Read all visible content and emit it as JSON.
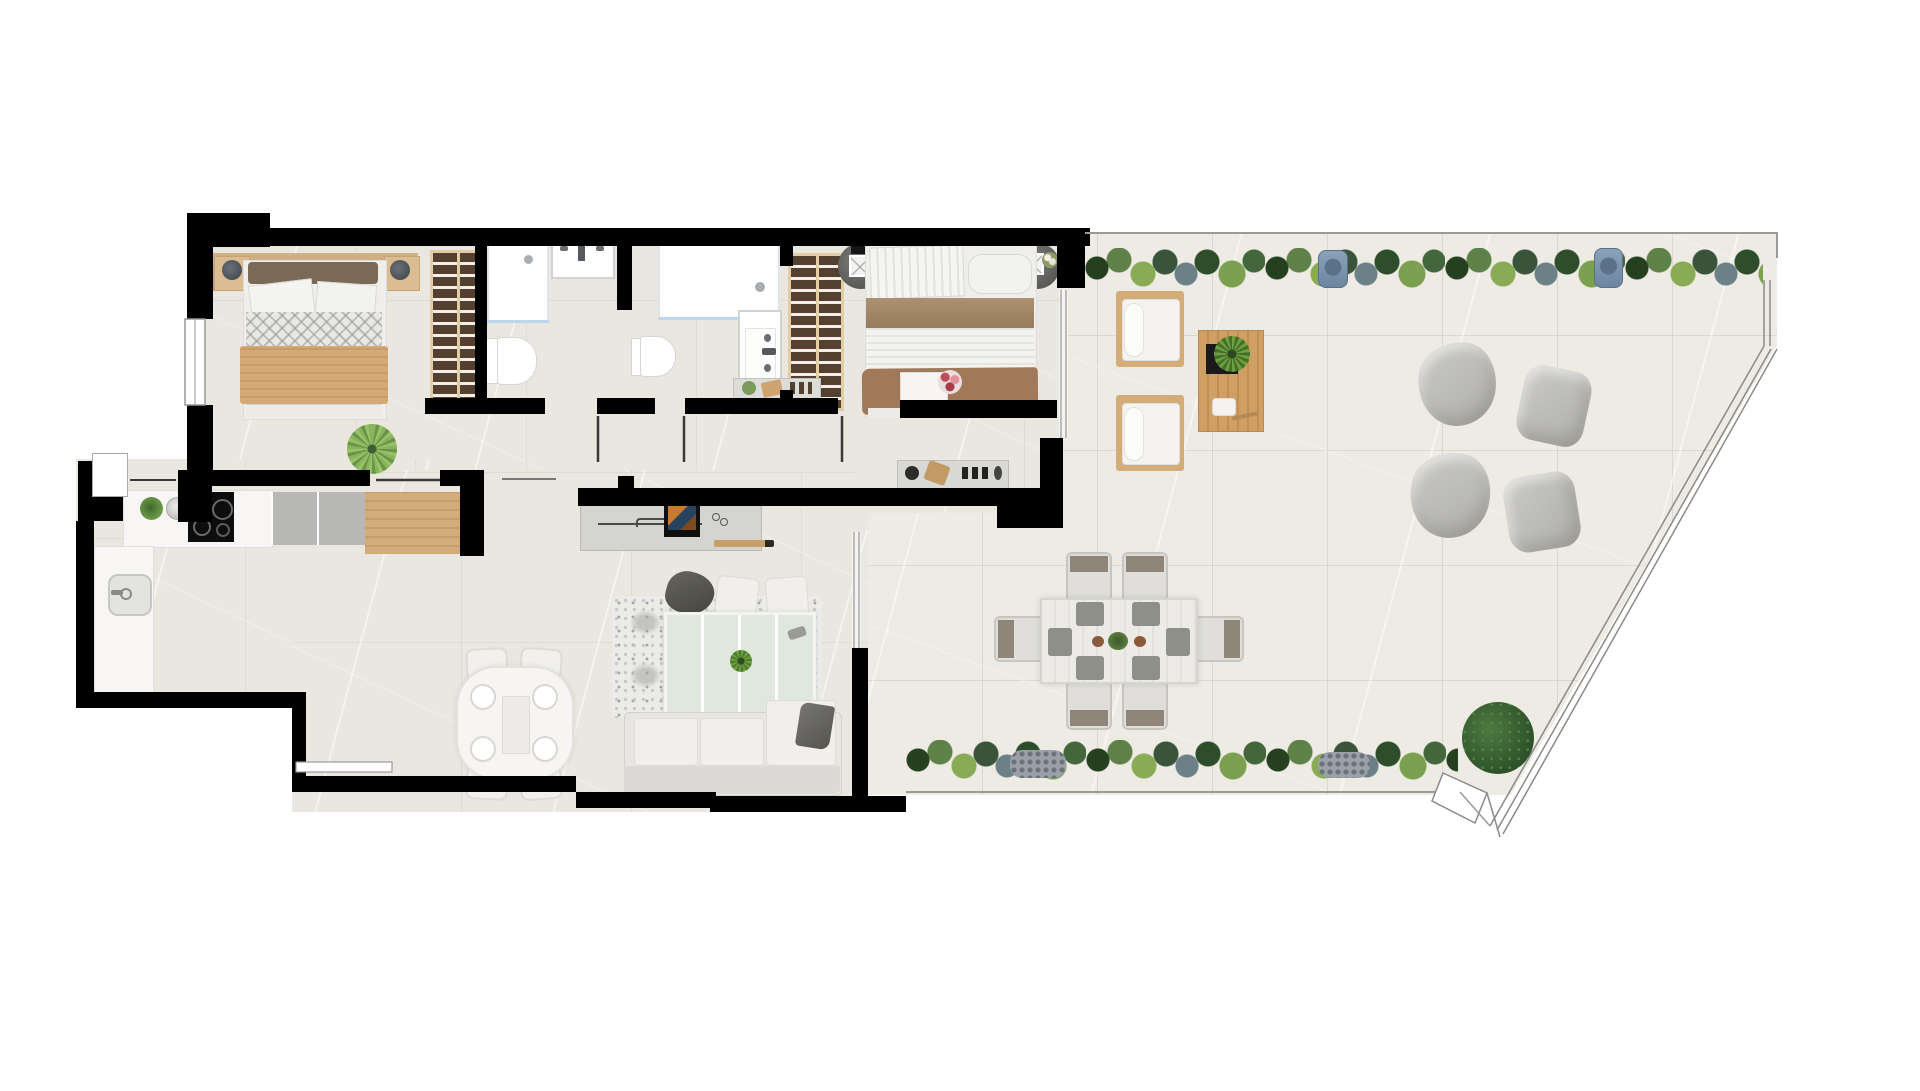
{
  "meta": {
    "type": "apartment-floor-plan-render",
    "canvas_width": 1920,
    "canvas_height": 1091,
    "visible_text": "none"
  },
  "palette": {
    "wall": "#000000",
    "floor": "#eae7e0",
    "terrace": "#edebe4",
    "white": "#f7f6f4",
    "wood": "#d2ac79",
    "woodlight": "#e3cba3",
    "wardrobe": "#54402e",
    "graycounter": "#b8b9b7",
    "bedtan": "#d5a975",
    "bedbrown": "#a0795a",
    "sofagray": "#e7e6e2",
    "bag": "#c3c2be",
    "line": "#9a9a96",
    "glass": "#bcd6ee",
    "pot": "#7d96ad"
  },
  "plan": {
    "rooms": [
      {
        "id": "bedroom-1",
        "furniture": [
          "double-bed",
          "headboard",
          "nightstand-left",
          "nightstand-right",
          "lamp",
          "lamp",
          "plant",
          "wardrobe",
          "window"
        ]
      },
      {
        "id": "bathroom-1",
        "furniture": [
          "shower-tray",
          "washbasin",
          "toilet"
        ]
      },
      {
        "id": "bathroom-2",
        "furniture": [
          "shower-tray",
          "vanity-sink",
          "toilet"
        ]
      },
      {
        "id": "bedroom-2",
        "furniture": [
          "double-bed",
          "round-nightstand-left",
          "round-nightstand-right",
          "wardrobe",
          "console-shelf",
          "sliding-glass-door"
        ]
      },
      {
        "id": "kitchen",
        "furniture": [
          "counter-run",
          "induction-hob",
          "appliance-column",
          "wood-counter",
          "sink",
          "kettle",
          "plant"
        ]
      },
      {
        "id": "entry",
        "furniture": [
          "front-door"
        ]
      },
      {
        "id": "dining-area",
        "furniture": [
          "round-table",
          "chair",
          "chair",
          "chair",
          "chair",
          "place-settings"
        ]
      },
      {
        "id": "living-room",
        "furniture": [
          "tv-sideboard",
          "tv",
          "soundbar",
          "rug",
          "glass-coffee-table",
          "pouf-dark",
          "floor-cushion",
          "floor-cushion",
          "sofa",
          "throw-blanket"
        ]
      },
      {
        "id": "hallway",
        "furniture": [
          "decor-console"
        ]
      },
      {
        "id": "terrace",
        "furniture": [
          "hedge-top",
          "planter-pot",
          "planter-pot",
          "lounge-chair",
          "lounge-chair",
          "wood-side-table",
          "beanbag",
          "beanbag",
          "beanbag",
          "beanbag",
          "dining-table-6",
          "outdoor-chair-x6",
          "hedge-bottom",
          "round-bush",
          "railing"
        ]
      }
    ],
    "doors": [
      "entry-door",
      "bedroom-1-door",
      "bathroom-1-door",
      "bathroom-2-door",
      "bedroom-2-door",
      "living-passage",
      "glass-slider-bedroom-2",
      "glass-slider-living"
    ]
  }
}
